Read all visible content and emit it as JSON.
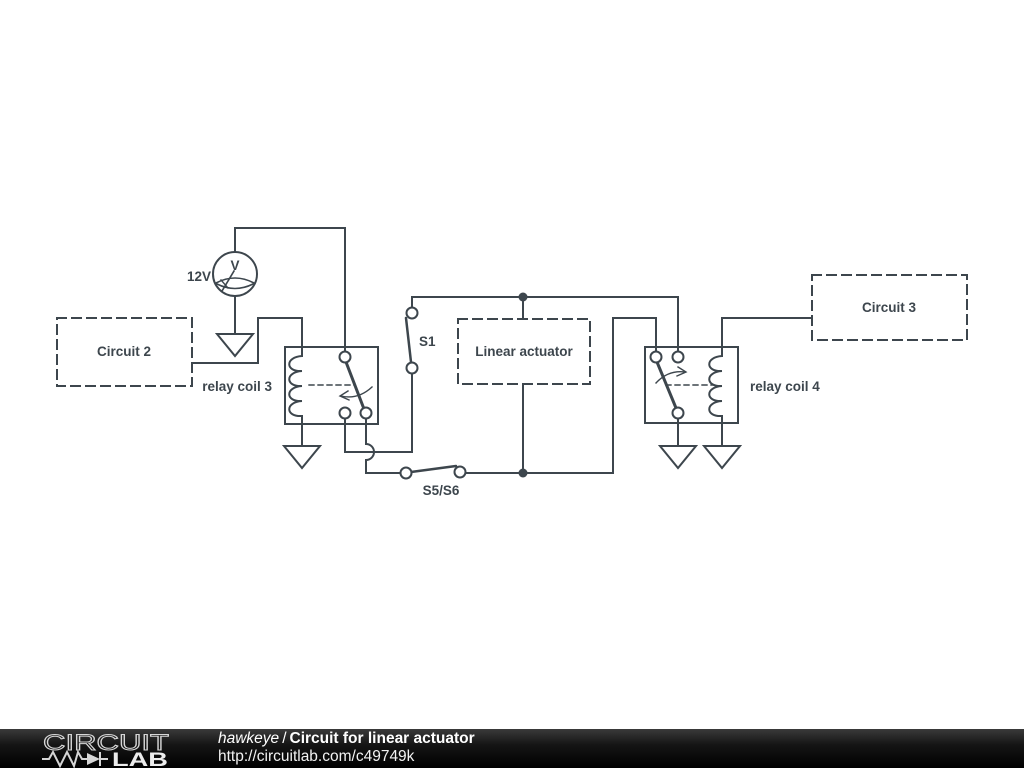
{
  "colors": {
    "background": "#ffffff",
    "wire": "#3d464d",
    "footer_bg": "#0d0d0d",
    "footer_text": "#ffffff",
    "logo_outline": "#d6d6d6"
  },
  "schematic": {
    "source": {
      "value": "12V",
      "glyph": "V"
    },
    "blocks": {
      "circuit2": "Circuit 2",
      "linear_actuator": "Linear actuator",
      "circuit3": "Circuit 3"
    },
    "relay3": {
      "label": "relay coil 3"
    },
    "relay4": {
      "label": "relay coil 4"
    },
    "switches": {
      "s1": "S1",
      "s5s6": "S5/S6"
    }
  },
  "footer": {
    "logo": {
      "line1": "CIRCUIT",
      "line2": "LAB"
    },
    "author": "hawkeye",
    "separator": "/",
    "title": "Circuit for linear actuator",
    "url": "http://circuitlab.com/c49749k"
  }
}
